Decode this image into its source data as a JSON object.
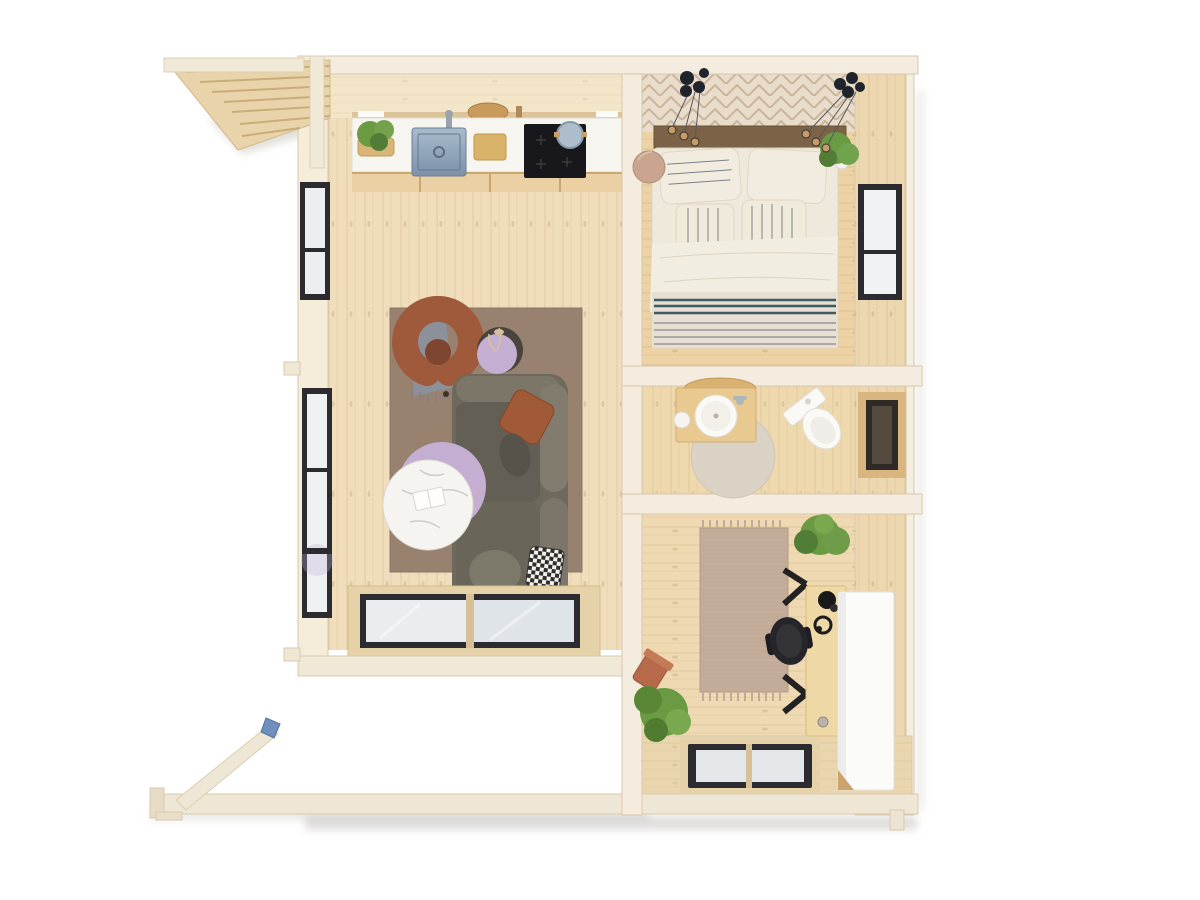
{
  "scene": {
    "type": "top-down 3d floor plan render",
    "subject": "log cabin interior with terrace framing",
    "rooms": [
      {
        "name": "living-room-kitchen",
        "items": [
          "kitchen counter",
          "herb basket",
          "faucet",
          "steel sink",
          "cutting board",
          "induction cooktop",
          "pot",
          "area rug",
          "curved armchair",
          "gray throw",
          "round side table",
          "marble coffee table",
          "lilac table",
          "sofa with pillows",
          "glazed patio doors",
          "two wall windows"
        ]
      },
      {
        "name": "bedroom",
        "items": [
          "parquet accent band",
          "two pendant light clusters",
          "wood headboard",
          "double bed with striped bedding",
          "round bedside stool",
          "potted plant",
          "window"
        ]
      },
      {
        "name": "bathroom",
        "items": [
          "wood vanity",
          "round basin",
          "cup",
          "round rug",
          "toilet",
          "small window"
        ]
      },
      {
        "name": "home-office",
        "items": [
          "runner rug with fringe",
          "trestle desk",
          "desk lamp",
          "headphones",
          "office chair",
          "tall white cabinet",
          "corner plant",
          "tipped plant pot",
          "bottom wall window"
        ]
      },
      {
        "name": "exterior",
        "items": [
          "slatted roof overhang",
          "corner post",
          "terrace base beam",
          "diagonal beam",
          "blue clamp"
        ]
      }
    ]
  },
  "colors": {
    "background": "#ffffff",
    "floor_living": "#f0ddbb",
    "floor_bedroom": "#ecd2a4",
    "floor_bath": "#eed8ae",
    "floor_office": "#eed9b2",
    "accent_parquet": "#e9dccb",
    "wall_light": "#f3ecdf",
    "wall_wood_face": "#ecd7b0",
    "ceiling_face": "#f3e6c8",
    "counter_white": "#f7f5f0",
    "cabinet_wood": "#ead0a2",
    "cooktop_black": "#17171c",
    "cutting_board": "#d9b36a",
    "rug_living": "#98816f",
    "armchair_rust": "#9e5a3b",
    "throw_gray": "#8b909a",
    "sofa_base": "#6e695d",
    "sofa_cushion": "#645f55",
    "sofa_back": "#827c6e",
    "pillow_rust": "#a15a38",
    "table_lilac": "#c4afd3",
    "table_dark": "#4a443e",
    "marble_white": "#f6f4f1",
    "headboard_wood": "#7c6347",
    "bed_linen": "#efe9dc",
    "stripe_navy": "#4a5668",
    "stripe_teal": "#3e5a63",
    "stool_blush": "#c9a48f",
    "vanity_wood": "#e8c98f",
    "rug_bath": "#d9d2c5",
    "porcelain_white": "#faf9f6",
    "rug_office": "#c2ab98",
    "desk_wood": "#eed9a6",
    "chair_black": "#26262a",
    "cabinet_white": "#fbfbfa",
    "plant_green": "#6a9a42",
    "plant_green_dark": "#517d36",
    "pot_terracotta": "#b66a4a",
    "window_frame": "#2c2c30",
    "glass_pale": "#e9edf0",
    "glass_dark": "#55493f",
    "deck_wood": "#efe7d5",
    "clamp_blue": "#6f8fbe",
    "pendant_black": "#20242c",
    "bulb_warm": "#c89a66"
  }
}
